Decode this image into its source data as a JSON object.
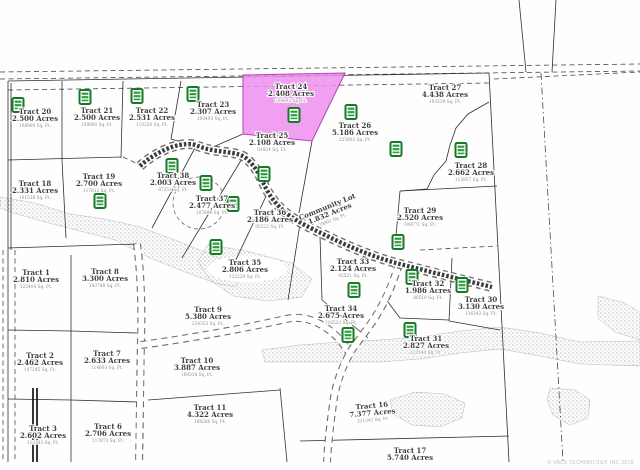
{
  "map": {
    "watermark": "© VALS TECHNOLOGY INC 2018",
    "highlighted_tract": "Tract 24",
    "colors": {
      "highlight_fill": "#ee8fee",
      "highlight_border": "#b840b8",
      "icon_green_border": "#177a29",
      "icon_green_bar": "#2f9e3f",
      "boundary_line": "#2f2f2f",
      "label_text": "#3f3f3f",
      "sqft_text": "#8a8a8a",
      "stipple_dot": "#9a9a9a",
      "road_dark": "#3c3c3c"
    },
    "tracts": [
      {
        "name": "Tract 20",
        "acres": "2.500 Acres",
        "sqft": "108900 Sq. Ft.",
        "x": 35,
        "y": 114
      },
      {
        "name": "Tract 21",
        "acres": "2.500 Acres",
        "sqft": "108900 Sq. Ft.",
        "x": 97,
        "y": 113
      },
      {
        "name": "Tract 22",
        "acres": "2.531 Acres",
        "sqft": "110250 Sq. Ft.",
        "x": 152,
        "y": 113
      },
      {
        "name": "Tract 23",
        "acres": "2.307 Acres",
        "sqft": "100493 Sq. Ft.",
        "x": 213,
        "y": 107
      },
      {
        "name": "Tract 24",
        "acres": "2.408 Acres",
        "sqft": "104892 Sq. Ft.",
        "x": 291,
        "y": 89,
        "highlighted": true
      },
      {
        "name": "Tract 25",
        "acres": "2.108 Acres",
        "sqft": "91824 Sq. Ft.",
        "x": 272,
        "y": 138
      },
      {
        "name": "Tract 26",
        "acres": "5.186 Acres",
        "sqft": "225902 Sq. Ft.",
        "x": 355,
        "y": 128
      },
      {
        "name": "Tract 27",
        "acres": "4.438 Acres",
        "sqft": "193319 Sq. Ft.",
        "x": 445,
        "y": 90
      },
      {
        "name": "Tract 28",
        "acres": "2.662 Acres",
        "sqft": "115957 Sq. Ft.",
        "x": 471,
        "y": 168
      },
      {
        "name": "Tract 18",
        "acres": "2.331 Acres",
        "sqft": "101538 Sq. Ft.",
        "x": 35,
        "y": 186
      },
      {
        "name": "Tract 19",
        "acres": "2.700 Acres",
        "sqft": "117612 Sq. Ft.",
        "x": 99,
        "y": 179
      },
      {
        "name": "Tract 38",
        "acres": "2.003 Acres",
        "sqft": "87251 Sq. Ft.",
        "x": 173,
        "y": 178
      },
      {
        "name": "Tract 37",
        "acres": "2.477 Acres",
        "sqft": "107898 Sq. Ft.",
        "x": 212,
        "y": 201
      },
      {
        "name": "Tract 36",
        "acres": "2.186 Acres",
        "sqft": "95222 Sq. Ft.",
        "x": 270,
        "y": 215
      },
      {
        "name": "Community Lot",
        "acres": "1.832 Acres",
        "sqft": "79802 Sq. Ft.",
        "x": 328,
        "y": 209,
        "rot": -22
      },
      {
        "name": "Tract 29",
        "acres": "2.520 Acres",
        "sqft": "109771 Sq. Ft.",
        "x": 420,
        "y": 213
      },
      {
        "name": "Tract 35",
        "acres": "2.806 Acres",
        "sqft": "122229 Sq. Ft.",
        "x": 245,
        "y": 265
      },
      {
        "name": "Tract 33",
        "acres": "2.124 Acres",
        "sqft": "92521 Sq. Ft.",
        "x": 353,
        "y": 264
      },
      {
        "name": "Tract 1",
        "acres": "2.810 Acres",
        "sqft": "122404 Sq. Ft.",
        "x": 36,
        "y": 275
      },
      {
        "name": "Tract 8",
        "acres": "3.300 Acres",
        "sqft": "143748 Sq. Ft.",
        "x": 105,
        "y": 274
      },
      {
        "name": "Tract 9",
        "acres": "5.380 Acres",
        "sqft": "234353 Sq. Ft.",
        "x": 208,
        "y": 312
      },
      {
        "name": "Tract 32",
        "acres": "1.986 Acres",
        "sqft": "86510 Sq. Ft.",
        "x": 428,
        "y": 286
      },
      {
        "name": "Tract 30",
        "acres": "3.130 Acres",
        "sqft": "136343 Sq. Ft.",
        "x": 481,
        "y": 302
      },
      {
        "name": "Tract 34",
        "acres": "2.675 Acres",
        "sqft": "116523 Sq. Ft.",
        "x": 341,
        "y": 311
      },
      {
        "name": "Tract 31",
        "acres": "2.827 Acres",
        "sqft": "123144 Sq. Ft.",
        "x": 426,
        "y": 341
      },
      {
        "name": "Tract 2",
        "acres": "2.462 Acres",
        "sqft": "107245 Sq. Ft.",
        "x": 40,
        "y": 358
      },
      {
        "name": "Tract 7",
        "acres": "2.633 Acres",
        "sqft": "114693 Sq. Ft.",
        "x": 107,
        "y": 356
      },
      {
        "name": "Tract 10",
        "acres": "3.887 Acres",
        "sqft": "169318 Sq. Ft.",
        "x": 197,
        "y": 363
      },
      {
        "name": "Tract 11",
        "acres": "4.322 Acres",
        "sqft": "188266 Sq. Ft.",
        "x": 210,
        "y": 410
      },
      {
        "name": "Tract 3",
        "acres": "2.602 Acres",
        "sqft": "113343 Sq. Ft.",
        "x": 43,
        "y": 431
      },
      {
        "name": "Tract 6",
        "acres": "2.706 Acres",
        "sqft": "117873 Sq. Ft.",
        "x": 108,
        "y": 429
      },
      {
        "name": "Tract 16",
        "acres": "7.377 Acres",
        "sqft": "321342 Sq. Ft.",
        "x": 372,
        "y": 408,
        "rot": -5
      },
      {
        "name": "Tract 17",
        "acres": "5.740 Acres",
        "sqft": "",
        "x": 410,
        "y": 453
      }
    ],
    "icons": [
      [
        18,
        105
      ],
      [
        85,
        97
      ],
      [
        137,
        96
      ],
      [
        193,
        94
      ],
      [
        294,
        115
      ],
      [
        351,
        112
      ],
      [
        396,
        149
      ],
      [
        461,
        150
      ],
      [
        100,
        201
      ],
      [
        172,
        166
      ],
      [
        206,
        183
      ],
      [
        233,
        204
      ],
      [
        264,
        174
      ],
      [
        216,
        247
      ],
      [
        354,
        290
      ],
      [
        398,
        242
      ],
      [
        412,
        277
      ],
      [
        462,
        285
      ],
      [
        348,
        335
      ],
      [
        410,
        330
      ]
    ],
    "geometry": {
      "highlight_polygon": "243,75 345,73 312,141 243,134",
      "solid_lines": [
        "M8,81 L489,73",
        "M8,81 L8,462",
        "M11,83 L11,250",
        "M489,73 L509,462",
        "M519,0 L526,72",
        "M556,0 L552,72",
        "M62,81 L62,160",
        "M123,81 L121,158",
        "M181,81 L171,139",
        "M8,160 L121,157",
        "M62,160 L66,238",
        "M171,139 L198,147",
        "M243,134 L206,150",
        "M312,141 L299,213",
        "M489,102 L468,114 L456,128 L450,145 L446,161 L434,175 L427,189 L400,191",
        "M400,191 L497,186",
        "M400,191 L396,236",
        "M196,146 L152,228",
        "M243,157 L182,258",
        "M268,192 L232,268",
        "M300,224 L288,300",
        "M320,236 L322,300",
        "M322,300 L368,338",
        "M385,298 L400,318",
        "M452,258 L449,321",
        "M400,318 L449,320",
        "M449,321 L500,330",
        "M8,248 L137,244",
        "M71,255 L71,462",
        "M8,330 L71,331 L137,333",
        "M8,399 L71,400 L138,402",
        "M148,400 L280,390",
        "M280,388 L287,462",
        "M300,441 L509,436"
      ],
      "dashed_lines": [
        "M0,72 L640,64",
        "M0,79 L640,71",
        "M8,90 L489,83",
        "M494,79 L640,72",
        "M3,250 L3,462",
        "M15,250 L15,462",
        "M123,157 L140,165",
        "M420,250 L497,246"
      ],
      "dashdot_lines": [
        "M541,73 L563,462"
      ],
      "heavy_lines": [
        "M33,388 L33,462",
        "M37,388 L37,462"
      ],
      "cul_de_sac": {
        "cx": 199,
        "cy": 203,
        "r": 26
      },
      "roads": {
        "main": "M140,166 C160,148 186,140 198,146 C218,154 238,150 247,159 C259,170 261,180 268,192 C281,214 300,223 323,234 C347,246 371,256 396,263 C423,270 455,278 492,287",
        "branch_south": "M399,264 C392,286 386,299 379,311 C370,327 359,339 351,351 C343,365 337,381 334,397 C331,418 328,441 327,462",
        "road_west": "M137,244 C141,274 142,308 141,340 C140,382 140,424 139,462",
        "road_cross": "M141,345 C192,338 242,329 286,319 C312,313 336,331 349,352"
      },
      "stipple_areas": [
        "0,197 35,203 70,214 105,219 140,227 175,240 205,252 228,262 240,272 236,287 215,283 185,272 150,258 115,240 80,231 45,222 10,212 0,208",
        "208,244 250,252 292,263 312,279 302,297 268,301 233,296 210,280 198,262",
        "262,350 300,345 340,342 380,340 420,337 460,331 500,327 540,333 580,342 640,341 640,366 580,364 540,356 500,349 460,353 420,359 380,362 340,362 300,362 265,362",
        "390,400 415,392 445,394 465,403 462,418 440,427 412,425 393,414",
        "550,388 575,390 590,400 588,418 570,425 553,415 547,400",
        "598,296 625,303 640,312 640,340 615,332 598,318"
      ],
      "stipple_holes": [
        [
          247,
          269,
          40,
          13
        ]
      ]
    }
  }
}
